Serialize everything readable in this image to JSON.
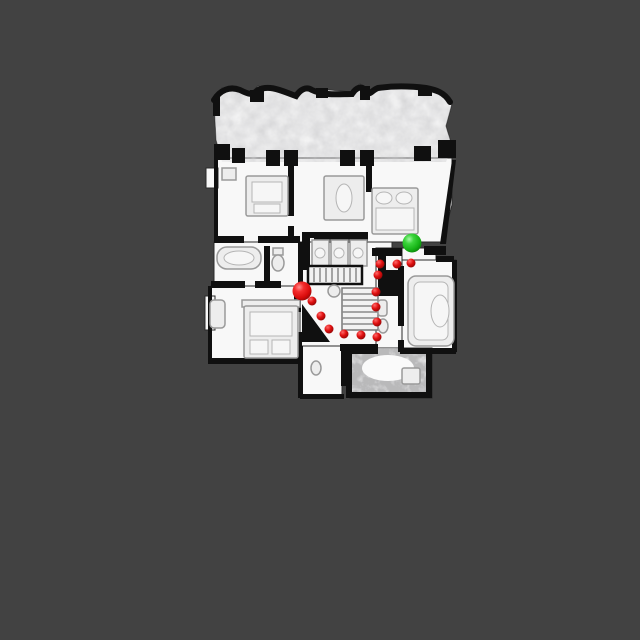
{
  "view": {
    "type": "topdown-navigation-map",
    "background_color": "#424242"
  },
  "floorplan": {
    "floor_color": "#f8f8f8",
    "wall_color": "#101010",
    "furniture_color": "#ededed"
  },
  "overlay": {
    "start": {
      "label": "agent-start-marker",
      "x": 302,
      "y": 291,
      "r": 9.5,
      "color": "#e01010"
    },
    "goal": {
      "label": "goal-marker",
      "x": 412,
      "y": 243,
      "r": 9.5,
      "color": "#1fbe27"
    },
    "path": {
      "color": "#e01010",
      "dot_radius": 4.5,
      "points": [
        [
          312,
          301
        ],
        [
          321,
          316
        ],
        [
          329,
          329
        ],
        [
          344,
          334
        ],
        [
          361,
          335
        ],
        [
          377,
          337
        ],
        [
          377,
          322
        ],
        [
          376,
          307
        ],
        [
          376,
          292
        ],
        [
          378,
          275
        ],
        [
          380,
          264
        ],
        [
          397,
          264
        ],
        [
          411,
          263
        ]
      ]
    }
  }
}
